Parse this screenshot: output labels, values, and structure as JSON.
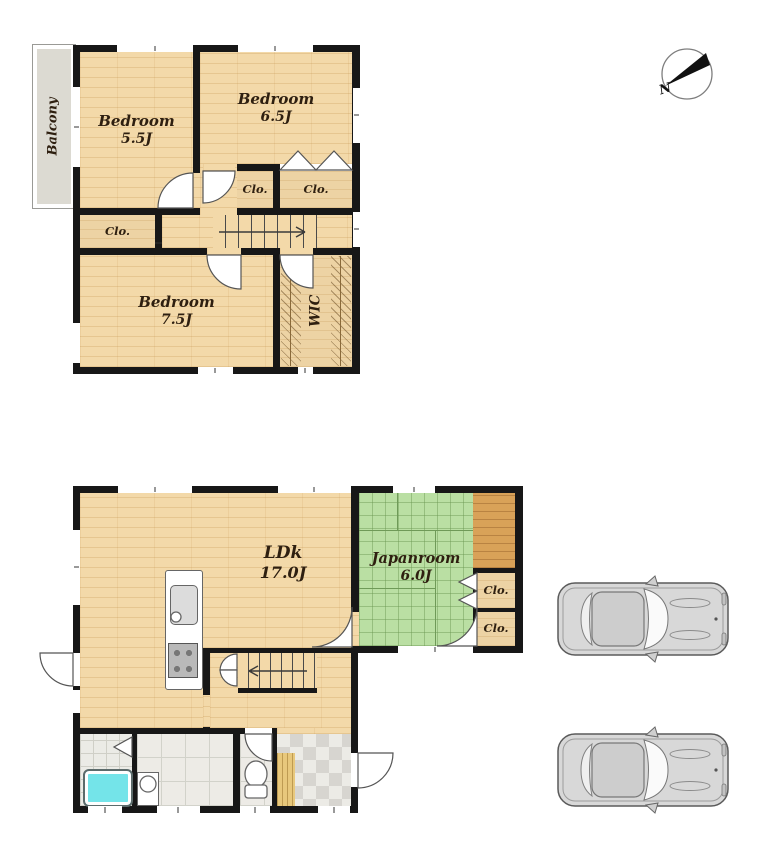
{
  "plan_type": "two-storey house floor plan",
  "colors": {
    "wall": "#171717",
    "wood_floor": "#f3d9a9",
    "tatami": "#badfa3",
    "alcove_wood": "#d9a258",
    "closet": "#edd3a4",
    "balcony": "#dcdad2",
    "bathtub": "#74e4e9",
    "tile": "#ebebe6",
    "label_text": "#2e1f10"
  },
  "floor2": {
    "balcony": "Balcony",
    "bedroom55": {
      "name": "Bedroom",
      "size": "5.5J"
    },
    "bedroom65": {
      "name": "Bedroom",
      "size": "6.5J"
    },
    "bedroom75": {
      "name": "Bedroom",
      "size": "7.5J"
    },
    "closet_mid": "Clo.",
    "closet_right": "Clo.",
    "closet_left": "Clo.",
    "wic": "WIC"
  },
  "floor1": {
    "ldk": {
      "name": "LDk",
      "size": "17.0J"
    },
    "japanroom": {
      "name": "Japanroom",
      "size": "6.0J"
    },
    "closet_top": "Clo.",
    "closet_bottom": "Clo."
  },
  "compass": {
    "north": "N"
  },
  "cars": {
    "count": 2
  }
}
